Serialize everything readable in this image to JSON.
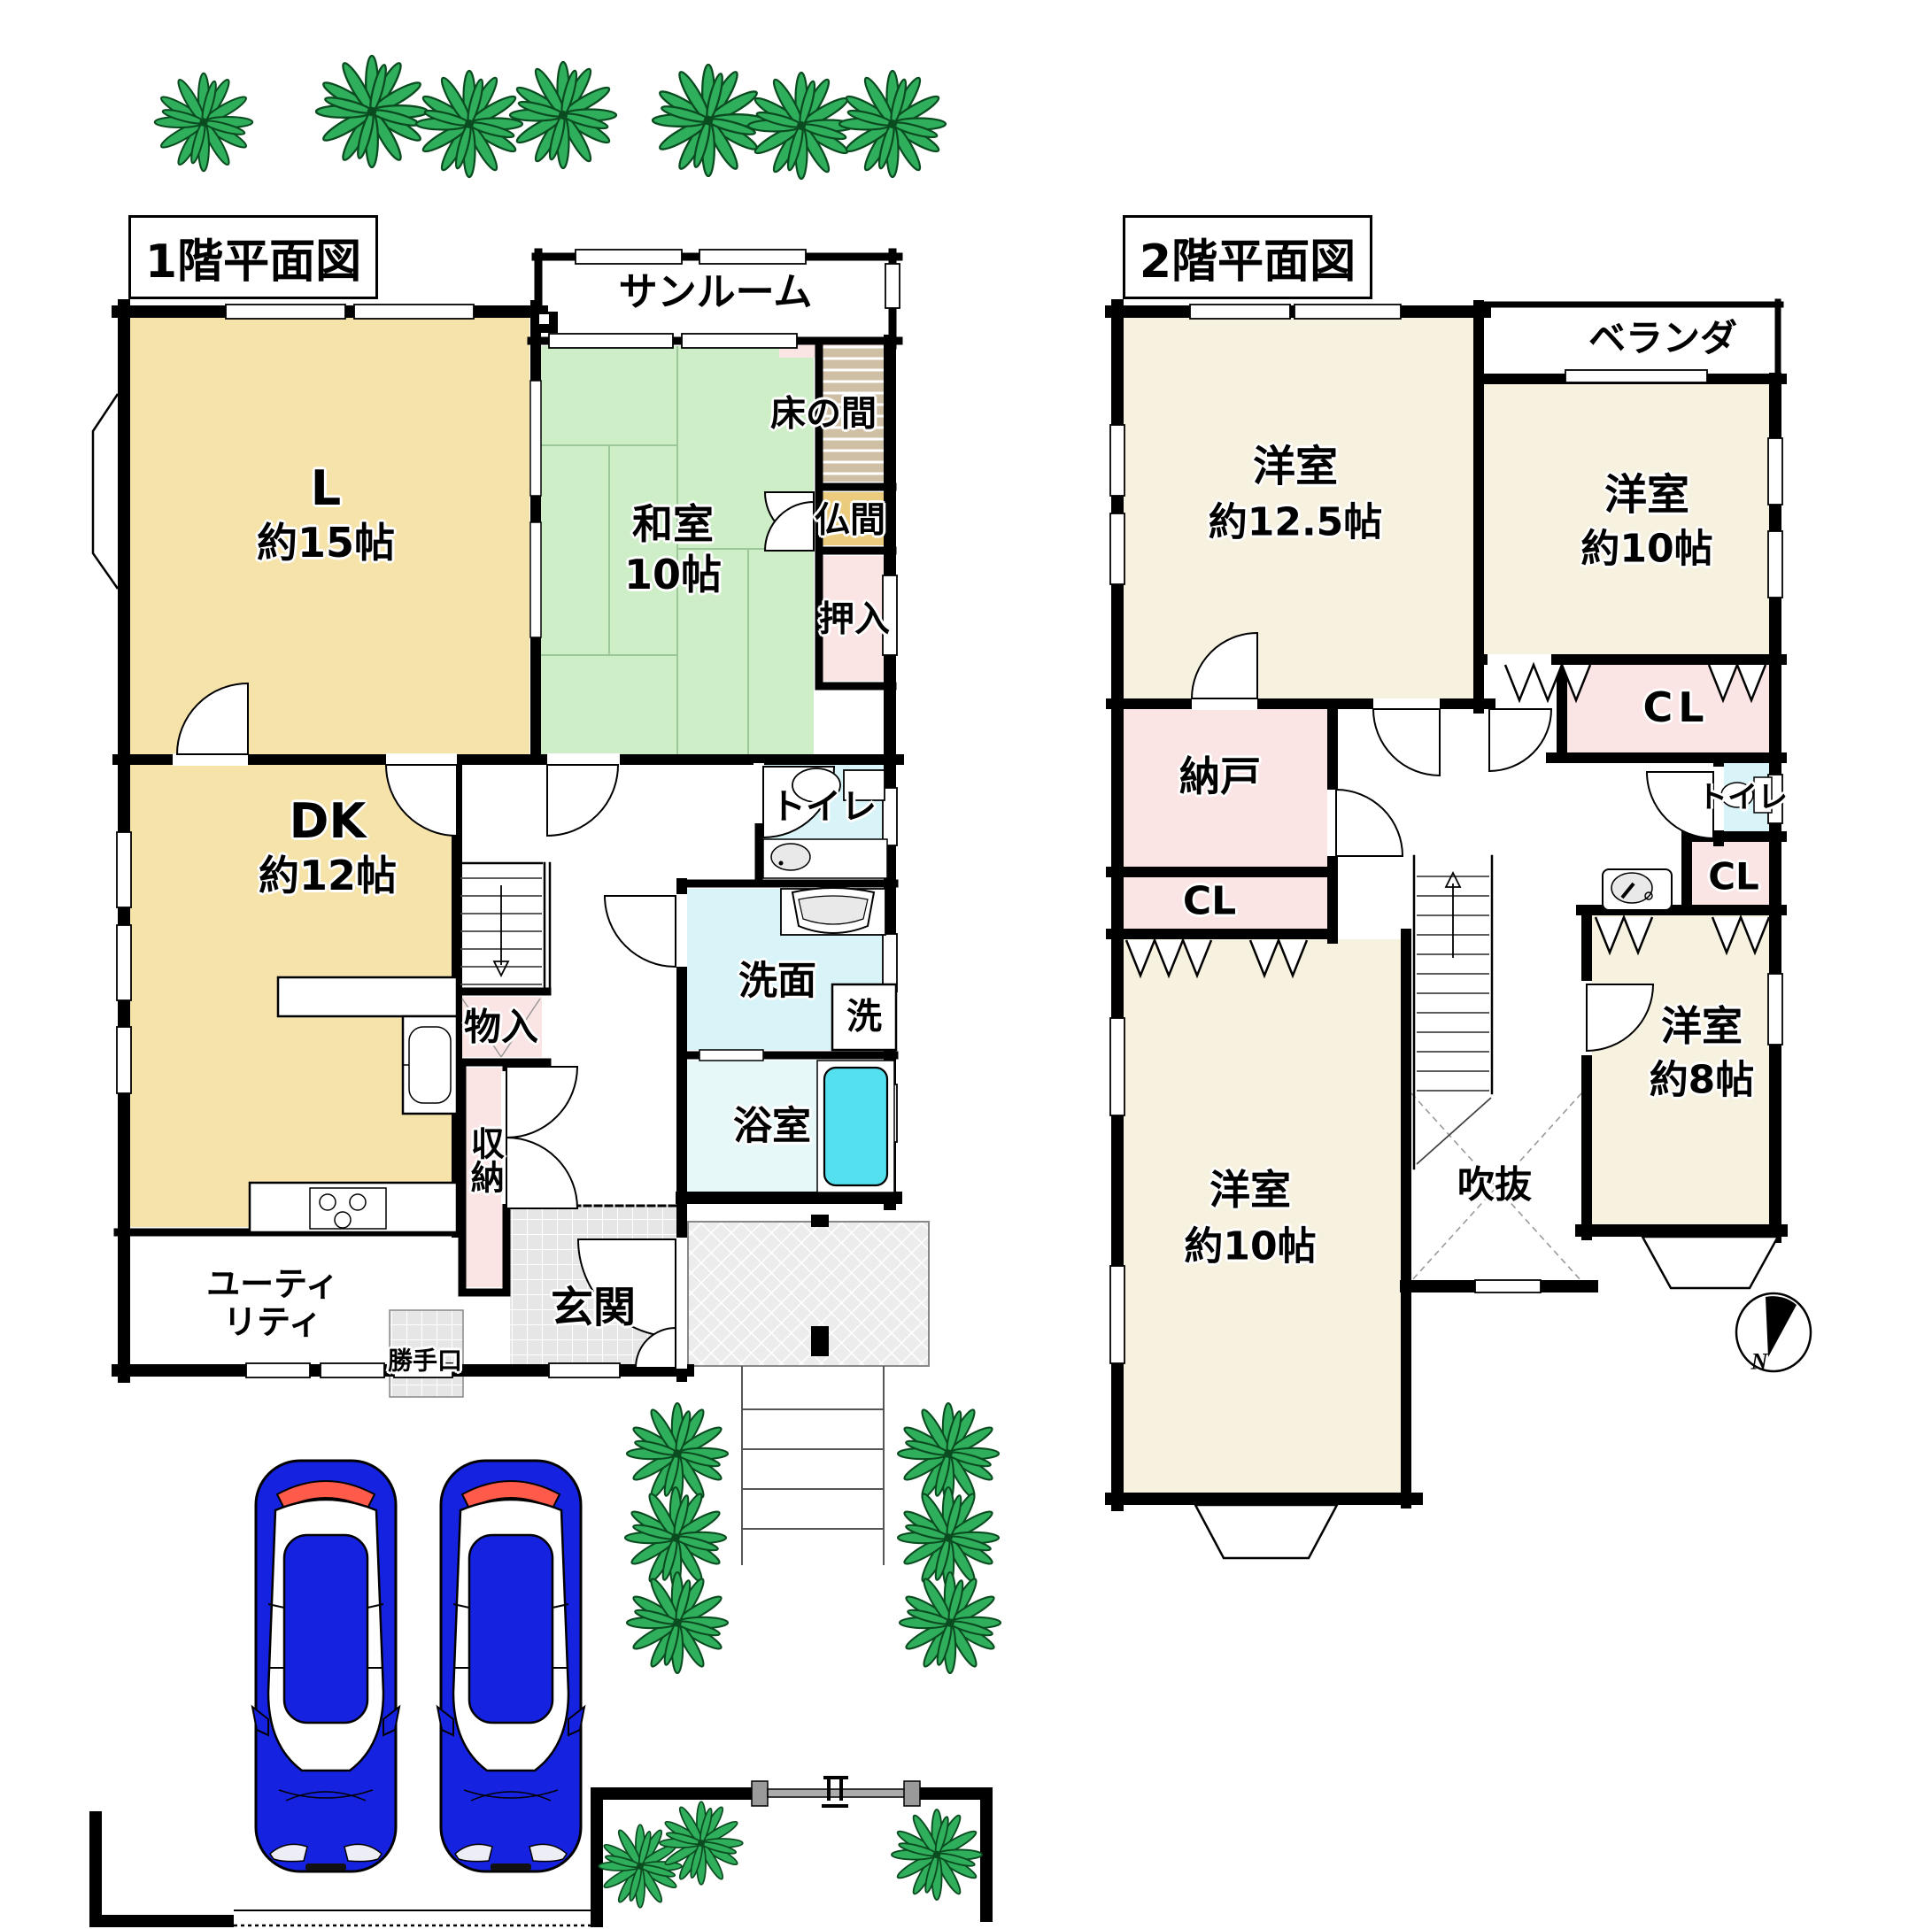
{
  "f1": {
    "title": "1階平面図",
    "living_name": "L",
    "living_size": "約15帖",
    "sunroom": "サンルーム",
    "washitsu_name": "和室",
    "washitsu_size": "10帖",
    "tokonoma": "床の間",
    "butsuma": "仏間",
    "oshiire": "押入",
    "dk_name": "DK",
    "dk_size": "約12帖",
    "toilet": "トイレ",
    "senmen": "洗面",
    "washer": "洗",
    "bath": "浴室",
    "monoire": "物入",
    "shuno": "収納",
    "utility": "ユーティ\nリティ",
    "katteguchi": "勝手口",
    "genkan": "玄関"
  },
  "f2": {
    "title": "2階平面図",
    "room125_name": "洋室",
    "room125_size": "約12.5帖",
    "veranda": "ベランダ",
    "room10a_name": "洋室",
    "room10a_size": "約10帖",
    "cl": "CL",
    "toilet": "トイレ",
    "room8_name": "洋室",
    "room8_size": "約8帖",
    "nando": "納戸",
    "room10b_name": "洋室",
    "room10b_size": "約10帖",
    "fukinuke": "吹抜"
  },
  "compass": {
    "north": "N"
  },
  "colors": {
    "wall": "#000000",
    "tan_room": "#F5E3A9",
    "cream_room": "#F7F1DF",
    "tatami_green": "#CDEEC6",
    "pink_storage": "#FBE4E4",
    "cyan_wet": "#D8F4F8",
    "bath_room": "#E7F8F8",
    "bathtub": "#55E0EF",
    "butsuma": "#EBCB7E",
    "tokonoma": "#CFC0A5",
    "tile": "#E6E6E6",
    "plant": "#2FAE5C",
    "car": "#1522E0"
  }
}
